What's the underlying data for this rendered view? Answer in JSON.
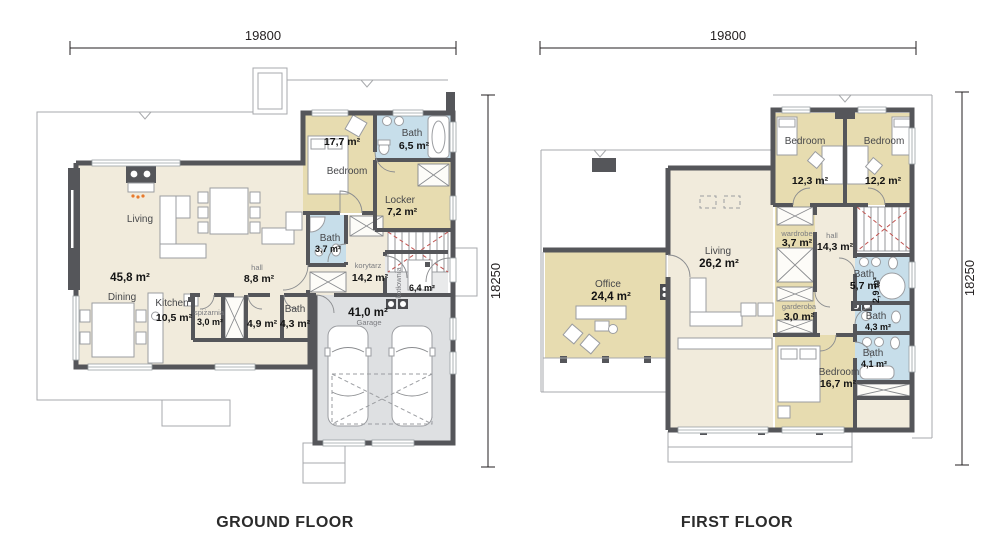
{
  "sheet": {
    "type": "house floor plan drawing",
    "colors": {
      "wall": "#55565a",
      "floor_cream": "#f1ebdc",
      "floor_tan": "#e7dcb0",
      "floor_bath_blue": "#c7deea",
      "floor_garage_gray": "#dee0e2",
      "thin_line": "#a7a9ac",
      "red_dash": "#c0504d",
      "flame_orange": "#e87a2e"
    }
  },
  "ground_floor": {
    "caption": "GROUND FLOOR",
    "dim_width": "19800",
    "dim_height": "18250",
    "rooms": {
      "living": {
        "name": "Living",
        "area": "45,8 m²"
      },
      "dining": {
        "name": "Dining"
      },
      "kitchen": {
        "name": "Kitchen",
        "area": "10,5 m²"
      },
      "pantry": {
        "name": "spiżarnia",
        "area": "3,0 m²"
      },
      "hall": {
        "name": "hall",
        "area": "8,8 m²"
      },
      "wc": {
        "area": "4,9 m²"
      },
      "bath_small": {
        "name": "Bath",
        "area": "4,3 m²"
      },
      "bedroom": {
        "name": "Bedroom",
        "area": "17,7 m²"
      },
      "bath_main": {
        "name": "Bath",
        "area": "6,5 m²"
      },
      "locker": {
        "name": "Locker",
        "area": "7,2 m²"
      },
      "bath_guest": {
        "name": "Bath",
        "area": "3,7 m²"
      },
      "corridor": {
        "name": "korytarz",
        "area": "14,2 m²"
      },
      "boiler": {
        "name": "kotłownia",
        "area": "6,4 m²"
      },
      "garage": {
        "name": "Garage",
        "area": "41,0 m²"
      }
    }
  },
  "first_floor": {
    "caption": "FIRST FLOOR",
    "dim_width": "19800",
    "dim_height": "18250",
    "rooms": {
      "office": {
        "name": "Office",
        "area": "24,4 m²"
      },
      "living": {
        "name": "Living",
        "area": "26,2 m²"
      },
      "bedroom_left": {
        "name": "Bedroom",
        "area": "12,3 m²"
      },
      "bedroom_right": {
        "name": "Bedroom",
        "area": "12,2 m²"
      },
      "wardrobe": {
        "name": "wardrobe",
        "area": "3,7 m²"
      },
      "hall": {
        "name": "hall",
        "area": "14,3 m²"
      },
      "bath_top": {
        "name": "Bath",
        "area": "5,7 m²"
      },
      "store": {
        "area": "2,9 m²"
      },
      "dressing": {
        "name": "garderoba",
        "area": "3,0 m²"
      },
      "bath_mid": {
        "name": "Bath",
        "area": "4,3 m²"
      },
      "bath_bottom": {
        "name": "Bath",
        "area": "4,1 m²"
      },
      "bedroom_bottom": {
        "name": "Bedroom",
        "area": "16,7 m²"
      }
    }
  }
}
